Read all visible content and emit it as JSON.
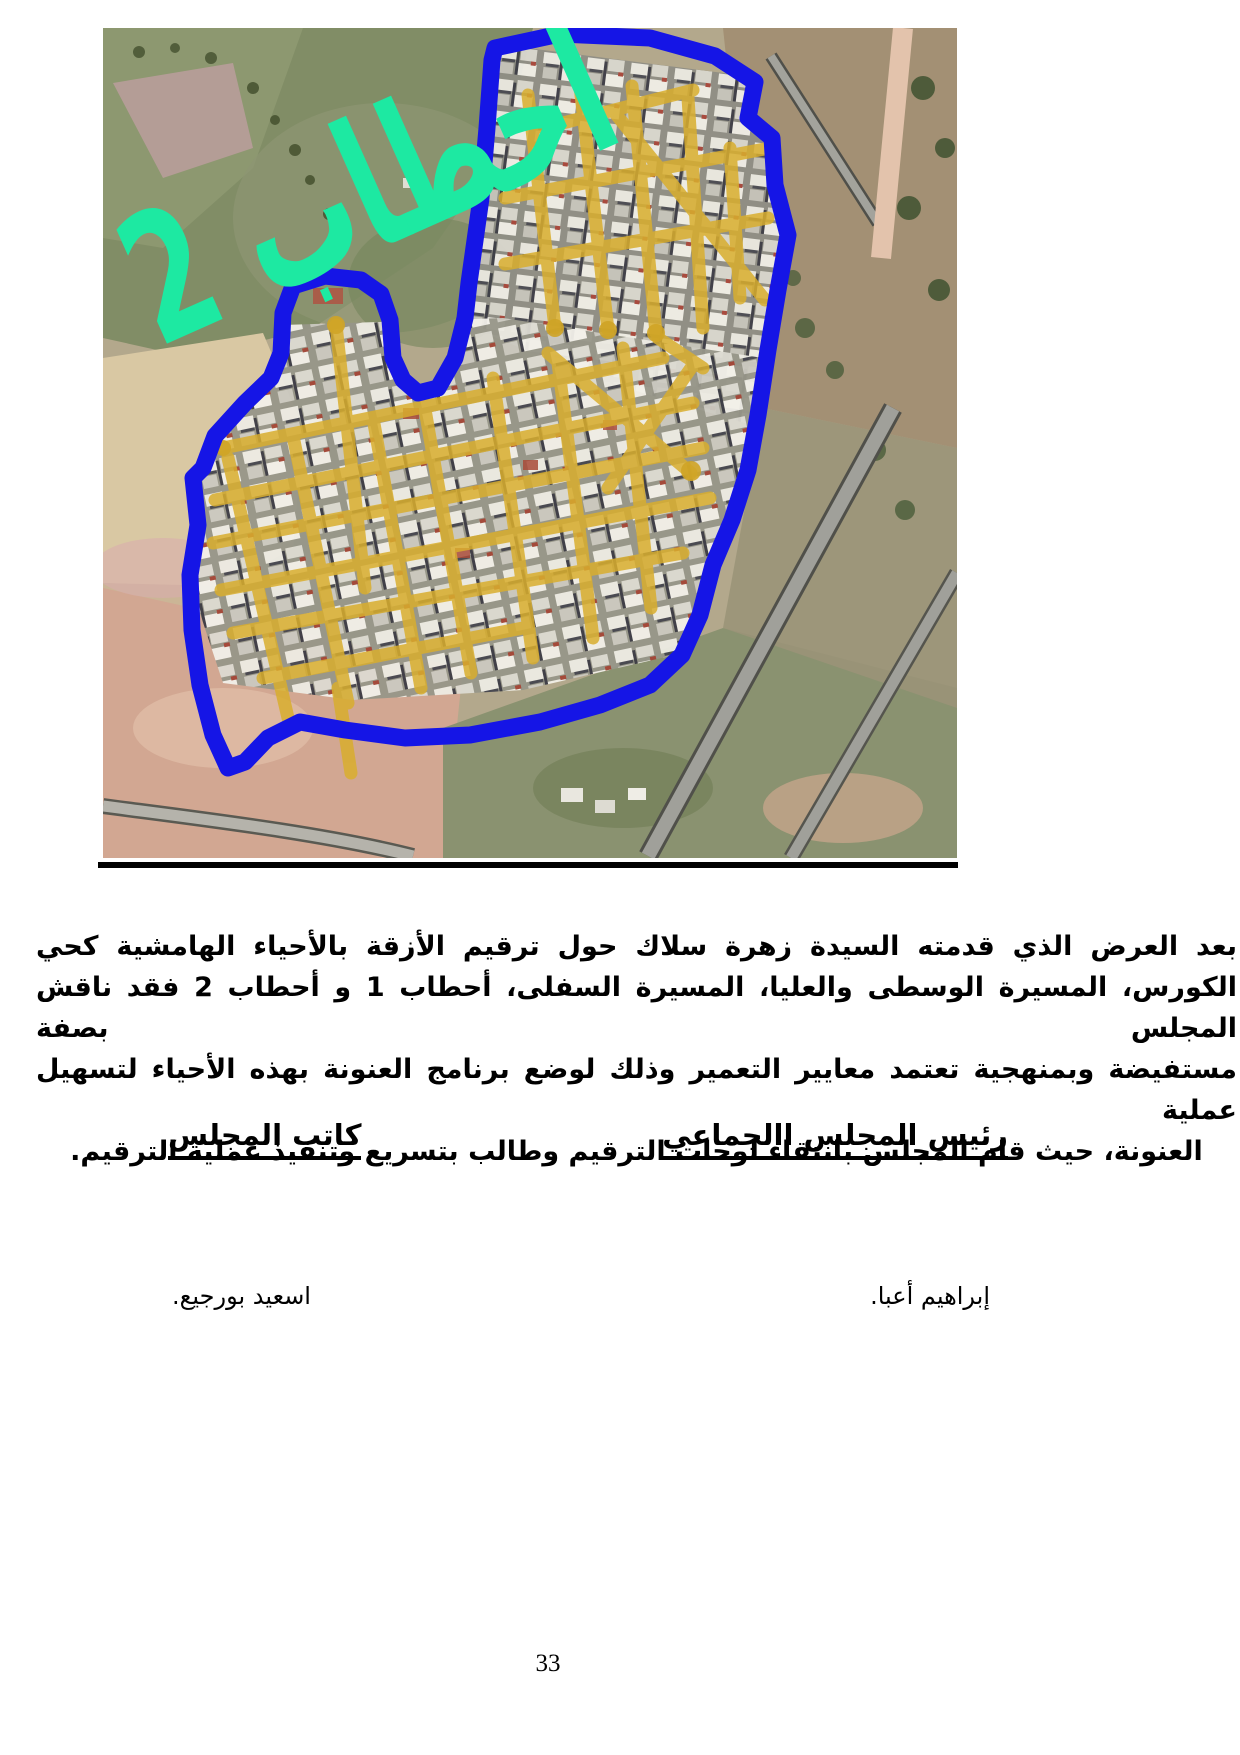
{
  "map": {
    "label": "احطاب 2",
    "label_color": "#1de9a2",
    "boundary_color": "#1515e6",
    "street_color": "#d9ae2e"
  },
  "paragraph": {
    "lines": [
      "بعد العرض الذي  قدمته السيدة زهرة سلاك حول ترقيم الأزقة بالأحياء الهامشية كحي",
      "الكورس، المسيرة الوسطى والعليا، المسيرة السفلى، أحطاب 1 و أحطاب 2 فقد ناقش المجلس بصفة",
      "مستفيضة وبمنهجية تعتمد معايير التعمير وذلك لوضع برنامج العنونة بهذه الأحياء لتسهيل عملية",
      "العنونة، حيث قام المجلس بانتقاء لوحات الترقيم وطالب بتسريع وتنفيذ عملية الترقيم."
    ]
  },
  "signatures": {
    "right": {
      "title": "رئيس المجلس االجماعي",
      "name": "إبراهيم أعبا."
    },
    "left": {
      "title": "كاتب المجلس",
      "name": "اسعيد بورجيع."
    }
  },
  "page": {
    "number": "33"
  }
}
